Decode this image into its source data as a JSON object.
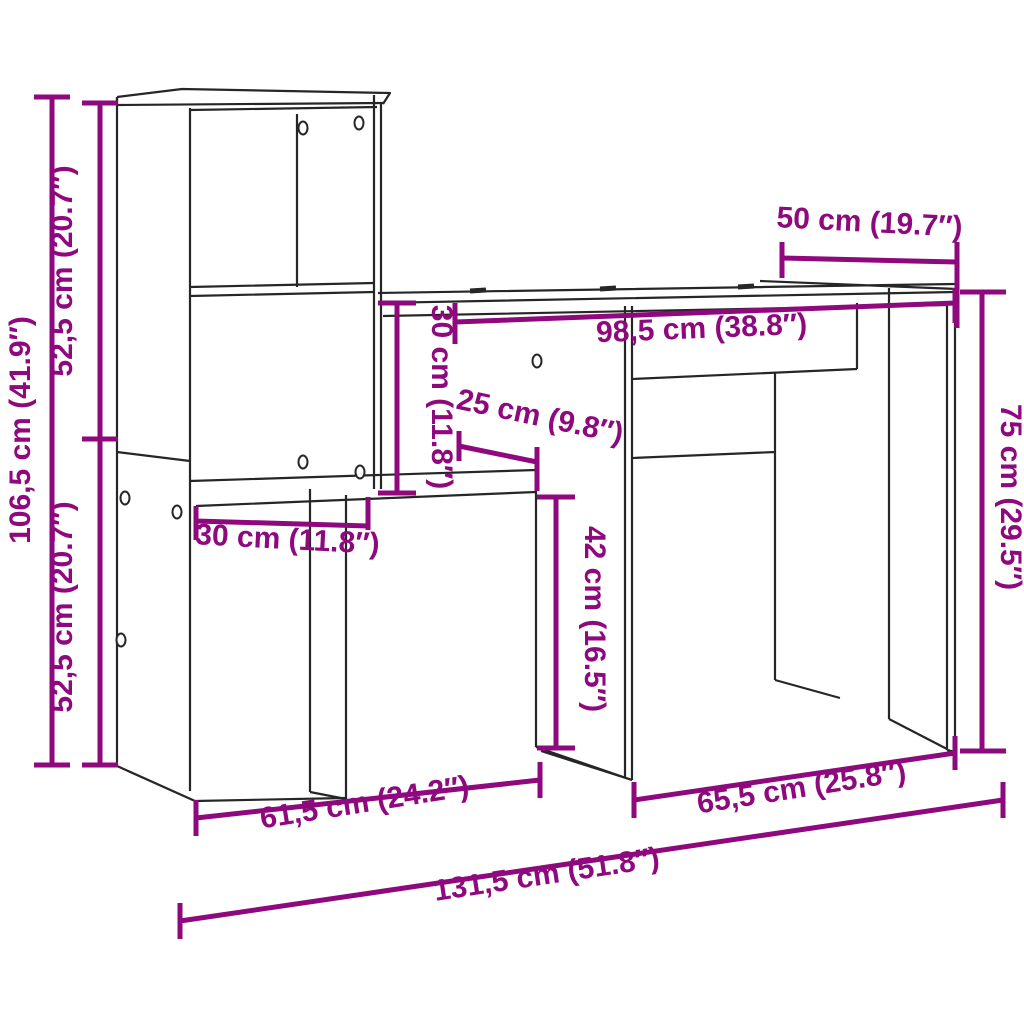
{
  "diagram": {
    "type": "furniture-dimension-diagram",
    "product": "desk-with-shelving-unit",
    "background": "#ffffff"
  },
  "colors": {
    "dimension": "#8e087e",
    "line_art": "#262626"
  },
  "dimensions": [
    {
      "id": "overall-height",
      "label": "106,5 cm (41.9″)",
      "cm": "106,5",
      "inch": "41.9"
    },
    {
      "id": "upper-section-height",
      "label": "52,5 cm (20.7″)",
      "cm": "52,5",
      "inch": "20.7"
    },
    {
      "id": "lower-section-height",
      "label": "52,5 cm (20.7″)",
      "cm": "52,5",
      "inch": "20.7"
    },
    {
      "id": "desktop-depth",
      "label": "50 cm (19.7″)",
      "cm": "50",
      "inch": "19.7"
    },
    {
      "id": "desktop-width",
      "label": "98,5 cm (38.8″)",
      "cm": "98,5",
      "inch": "38.8"
    },
    {
      "id": "shelf-opening-height",
      "label": "30 cm (11.8″)",
      "cm": "30",
      "inch": "11.8"
    },
    {
      "id": "shelf-depth",
      "label": "25 cm (9.8″)",
      "cm": "25",
      "inch": "9.8"
    },
    {
      "id": "shelf-width",
      "label": "30 cm (11.8″)",
      "cm": "30",
      "inch": "11.8"
    },
    {
      "id": "under-shelf-clearance",
      "label": "42 cm (16.5″)",
      "cm": "42",
      "inch": "16.5"
    },
    {
      "id": "desk-height",
      "label": "75 cm (29.5″)",
      "cm": "75",
      "inch": "29.5"
    },
    {
      "id": "left-section-width",
      "label": "61,5 cm (24.2″)",
      "cm": "61,5",
      "inch": "24.2"
    },
    {
      "id": "right-section-width",
      "label": "65,5 cm (25.8″)",
      "cm": "65,5",
      "inch": "25.8"
    },
    {
      "id": "overall-width",
      "label": "131,5 cm (51.8″)",
      "cm": "131,5",
      "inch": "51.8"
    }
  ]
}
